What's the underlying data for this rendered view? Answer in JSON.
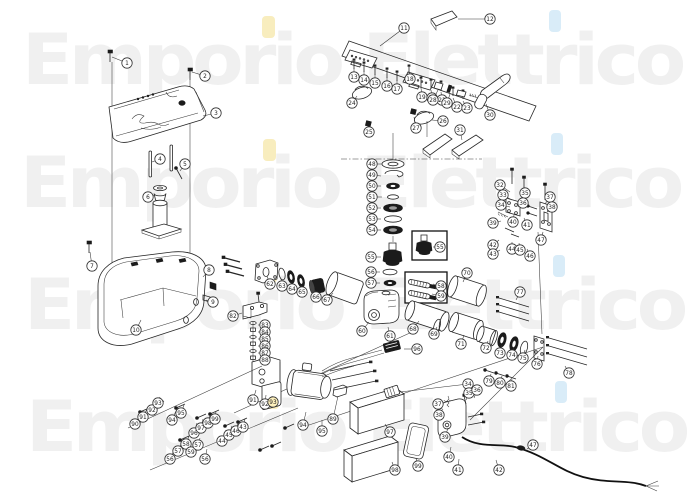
{
  "watermark": {
    "text": "Emporio Elettrico",
    "color": "#f0f0f0",
    "rows": [
      {
        "x": 22,
        "y": 84
      },
      {
        "x": 20,
        "y": 207
      },
      {
        "x": 24,
        "y": 329
      },
      {
        "x": 26,
        "y": 451
      }
    ],
    "accent_dots": [
      {
        "x": 262,
        "y": 16,
        "w": 13,
        "h": 22,
        "color": "#f6e9ae"
      },
      {
        "x": 263,
        "y": 139,
        "w": 13,
        "h": 22,
        "color": "#f6e9ae"
      },
      {
        "x": 264,
        "y": 261,
        "w": 13,
        "h": 22,
        "color": "#f6e9ae"
      },
      {
        "x": 266,
        "y": 387,
        "w": 13,
        "h": 22,
        "color": "#f6e9ae"
      },
      {
        "x": 549,
        "y": 10,
        "w": 12,
        "h": 22,
        "color": "#cfe7f6"
      },
      {
        "x": 551,
        "y": 133,
        "w": 12,
        "h": 22,
        "color": "#cfe7f6"
      },
      {
        "x": 553,
        "y": 255,
        "w": 12,
        "h": 22,
        "color": "#cfe7f6"
      },
      {
        "x": 555,
        "y": 381,
        "w": 12,
        "h": 22,
        "color": "#cfe7f6"
      }
    ]
  },
  "colors": {
    "background": "#ffffff",
    "line": "#262626",
    "dark_fill": "#1b1b1b",
    "balloon_stroke": "#333333",
    "balloon_text": "#222222",
    "highlight": "#fdf0bc"
  },
  "callouts": [
    {
      "n": 1,
      "x": 127,
      "y": 63,
      "lx": 112,
      "ly": 57
    },
    {
      "n": 2,
      "x": 205,
      "y": 76,
      "lx": 192,
      "ly": 72
    },
    {
      "n": 3,
      "x": 216,
      "y": 113,
      "lx": 203,
      "ly": 116
    },
    {
      "n": 4,
      "x": 160,
      "y": 159,
      "lx": 152,
      "ly": 162
    },
    {
      "n": 5,
      "x": 185,
      "y": 164,
      "lx": 180,
      "ly": 171
    },
    {
      "n": 6,
      "x": 148,
      "y": 197,
      "lx": 156,
      "ly": 195
    },
    {
      "n": 7,
      "x": 92,
      "y": 266,
      "lx": 90,
      "ly": 252
    },
    {
      "n": 8,
      "x": 209,
      "y": 270,
      "lx": 203,
      "ly": 277
    },
    {
      "n": 9,
      "x": 213,
      "y": 302,
      "lx": 206,
      "ly": 300
    },
    {
      "n": 10,
      "x": 136,
      "y": 330,
      "lx": 141,
      "ly": 320
    },
    {
      "n": 11,
      "x": 404,
      "y": 28,
      "lx": 380,
      "ly": 46
    },
    {
      "n": 12,
      "x": 490,
      "y": 19,
      "lx": 458,
      "ly": 19
    },
    {
      "n": 13,
      "x": 354,
      "y": 77,
      "lx": 354,
      "ly": 68
    },
    {
      "n": 14,
      "x": 364,
      "y": 80,
      "lx": 364,
      "ly": 71
    },
    {
      "n": 15,
      "x": 375,
      "y": 83,
      "lx": 375,
      "ly": 74
    },
    {
      "n": 16,
      "x": 387,
      "y": 86,
      "lx": 387,
      "ly": 77
    },
    {
      "n": 17,
      "x": 397,
      "y": 89,
      "lx": 397,
      "ly": 80
    },
    {
      "n": 18,
      "x": 410,
      "y": 79,
      "lx": 409,
      "ly": 71
    },
    {
      "n": 19,
      "x": 422,
      "y": 97,
      "lx": 421,
      "ly": 88
    },
    {
      "n": 20,
      "x": 432,
      "y": 98,
      "lx": 431,
      "ly": 90
    },
    {
      "n": 21,
      "x": 442,
      "y": 100,
      "lx": 441,
      "ly": 92
    },
    {
      "n": 22,
      "x": 457,
      "y": 107,
      "lx": 453,
      "ly": 98
    },
    {
      "n": 23,
      "x": 467,
      "y": 108,
      "lx": 463,
      "ly": 101
    },
    {
      "n": 24,
      "x": 352,
      "y": 103,
      "lx": 357,
      "ly": 96
    },
    {
      "n": 25,
      "x": 369,
      "y": 132,
      "lx": 368,
      "ly": 127
    },
    {
      "n": 26,
      "x": 443,
      "y": 121,
      "lx": 432,
      "ly": 120
    },
    {
      "n": 27,
      "x": 416,
      "y": 128,
      "lx": 414,
      "ly": 117
    },
    {
      "n": 28,
      "x": 433,
      "y": 100,
      "lx": 438,
      "ly": 90
    },
    {
      "n": 29,
      "x": 447,
      "y": 103,
      "lx": 450,
      "ly": 94
    },
    {
      "n": 30,
      "x": 490,
      "y": 115,
      "lx": 486,
      "ly": 104
    },
    {
      "n": 31,
      "x": 460,
      "y": 130,
      "lx": 462,
      "ly": 140
    },
    {
      "n": 32,
      "x": 500,
      "y": 185,
      "lx": 510,
      "ly": 192
    },
    {
      "n": 33,
      "x": 503,
      "y": 195,
      "lx": 512,
      "ly": 200
    },
    {
      "n": 34,
      "x": 501,
      "y": 205,
      "lx": 510,
      "ly": 207
    },
    {
      "n": 35,
      "x": 525,
      "y": 193,
      "lx": 520,
      "ly": 200
    },
    {
      "n": 36,
      "x": 523,
      "y": 203,
      "lx": 518,
      "ly": 207
    },
    {
      "n": 37,
      "x": 550,
      "y": 197,
      "lx": 545,
      "ly": 204
    },
    {
      "n": 38,
      "x": 552,
      "y": 207,
      "lx": 547,
      "ly": 212
    },
    {
      "n": 39,
      "x": 493,
      "y": 223,
      "lx": 501,
      "ly": 221
    },
    {
      "n": 40,
      "x": 513,
      "y": 222,
      "lx": 514,
      "ly": 215
    },
    {
      "n": 41,
      "x": 527,
      "y": 225,
      "lx": 524,
      "ly": 218
    },
    {
      "n": 42,
      "x": 493,
      "y": 245,
      "lx": 499,
      "ly": 240
    },
    {
      "n": 43,
      "x": 493,
      "y": 254,
      "lx": 500,
      "ly": 250
    },
    {
      "n": 44,
      "x": 512,
      "y": 249,
      "lx": 512,
      "ly": 242
    },
    {
      "n": 45,
      "x": 520,
      "y": 250,
      "lx": 519,
      "ly": 243
    },
    {
      "n": 46,
      "x": 530,
      "y": 256,
      "lx": 527,
      "ly": 249
    },
    {
      "n": 47,
      "x": 541,
      "y": 240,
      "lx": 543,
      "ly": 232
    },
    {
      "n": 48,
      "x": 372,
      "y": 164,
      "lx": 382,
      "ly": 164
    },
    {
      "n": 49,
      "x": 372,
      "y": 175,
      "lx": 381,
      "ly": 176
    },
    {
      "n": 50,
      "x": 372,
      "y": 186,
      "lx": 381,
      "ly": 186
    },
    {
      "n": 51,
      "x": 372,
      "y": 197,
      "lx": 382,
      "ly": 197
    },
    {
      "n": 52,
      "x": 372,
      "y": 208,
      "lx": 381,
      "ly": 208
    },
    {
      "n": 53,
      "x": 372,
      "y": 219,
      "lx": 381,
      "ly": 219
    },
    {
      "n": 54,
      "x": 372,
      "y": 230,
      "lx": 381,
      "ly": 230
    },
    {
      "n": 55,
      "x": 371,
      "y": 257,
      "lx": 381,
      "ly": 257
    },
    {
      "n": 55,
      "x": 440,
      "y": 247,
      "lx": 433,
      "ly": 247
    },
    {
      "n": 56,
      "x": 371,
      "y": 272,
      "lx": 380,
      "ly": 272
    },
    {
      "n": 57,
      "x": 371,
      "y": 283,
      "lx": 380,
      "ly": 283
    },
    {
      "n": 58,
      "x": 441,
      "y": 286,
      "lx": 433,
      "ly": 284
    },
    {
      "n": 59,
      "x": 441,
      "y": 296,
      "lx": 432,
      "ly": 294
    },
    {
      "n": 60,
      "x": 362,
      "y": 331,
      "lx": 369,
      "ly": 322
    },
    {
      "n": 61,
      "x": 390,
      "y": 336,
      "lx": 388,
      "ly": 327
    },
    {
      "n": 62,
      "x": 270,
      "y": 284,
      "lx": 267,
      "ly": 276
    },
    {
      "n": 63,
      "x": 282,
      "y": 286,
      "lx": 281,
      "ly": 279
    },
    {
      "n": 64,
      "x": 292,
      "y": 289,
      "lx": 291,
      "ly": 282
    },
    {
      "n": 65,
      "x": 302,
      "y": 292,
      "lx": 301,
      "ly": 285
    },
    {
      "n": 66,
      "x": 316,
      "y": 297,
      "lx": 315,
      "ly": 290
    },
    {
      "n": 67,
      "x": 327,
      "y": 300,
      "lx": 333,
      "ly": 293
    },
    {
      "n": 68,
      "x": 413,
      "y": 329,
      "lx": 419,
      "ly": 321
    },
    {
      "n": 69,
      "x": 434,
      "y": 334,
      "lx": 437,
      "ly": 327
    },
    {
      "n": 70,
      "x": 467,
      "y": 273,
      "lx": 463,
      "ly": 282
    },
    {
      "n": 71,
      "x": 461,
      "y": 344,
      "lx": 464,
      "ly": 335
    },
    {
      "n": 72,
      "x": 486,
      "y": 348,
      "lx": 488,
      "ly": 341
    },
    {
      "n": 73,
      "x": 500,
      "y": 353,
      "lx": 502,
      "ly": 345
    },
    {
      "n": 74,
      "x": 512,
      "y": 355,
      "lx": 514,
      "ly": 347
    },
    {
      "n": 75,
      "x": 523,
      "y": 358,
      "lx": 525,
      "ly": 350
    },
    {
      "n": 76,
      "x": 537,
      "y": 364,
      "lx": 538,
      "ly": 356
    },
    {
      "n": 77,
      "x": 520,
      "y": 292,
      "lx": 516,
      "ly": 300
    },
    {
      "n": 78,
      "x": 569,
      "y": 373,
      "lx": 565,
      "ly": 366
    },
    {
      "n": 79,
      "x": 489,
      "y": 381,
      "lx": 491,
      "ly": 374
    },
    {
      "n": 80,
      "x": 500,
      "y": 383,
      "lx": 502,
      "ly": 376
    },
    {
      "n": 81,
      "x": 511,
      "y": 386,
      "lx": 512,
      "ly": 379
    },
    {
      "n": 82,
      "x": 233,
      "y": 316,
      "lx": 242,
      "ly": 313
    },
    {
      "n": 83,
      "x": 265,
      "y": 325,
      "lx": 258,
      "ly": 325
    },
    {
      "n": 84,
      "x": 265,
      "y": 332,
      "lx": 258,
      "ly": 332
    },
    {
      "n": 85,
      "x": 265,
      "y": 339,
      "lx": 258,
      "ly": 339
    },
    {
      "n": 86,
      "x": 265,
      "y": 346,
      "lx": 258,
      "ly": 346
    },
    {
      "n": 87,
      "x": 265,
      "y": 353,
      "lx": 258,
      "ly": 353
    },
    {
      "n": 88,
      "x": 265,
      "y": 360,
      "lx": 258,
      "ly": 360
    },
    {
      "n": 89,
      "x": 333,
      "y": 419,
      "lx": 338,
      "ly": 396
    },
    {
      "n": 90,
      "x": 135,
      "y": 424,
      "lx": 141,
      "ly": 414
    },
    {
      "n": 91,
      "x": 143,
      "y": 417,
      "lx": 147,
      "ly": 409
    },
    {
      "n": 92,
      "x": 152,
      "y": 410,
      "lx": 155,
      "ly": 403
    },
    {
      "n": 93,
      "x": 158,
      "y": 403,
      "lx": 160,
      "ly": 397
    },
    {
      "n": 94,
      "x": 172,
      "y": 420,
      "lx": 176,
      "ly": 411
    },
    {
      "n": 95,
      "x": 181,
      "y": 413,
      "lx": 184,
      "ly": 405
    },
    {
      "n": 96,
      "x": 194,
      "y": 433,
      "lx": 197,
      "ly": 423
    },
    {
      "n": 97,
      "x": 201,
      "y": 428,
      "lx": 203,
      "ly": 419
    },
    {
      "n": 98,
      "x": 208,
      "y": 423,
      "lx": 210,
      "ly": 415
    },
    {
      "n": 99,
      "x": 215,
      "y": 419,
      "lx": 216,
      "ly": 411
    },
    {
      "n": 44,
      "x": 222,
      "y": 441,
      "lx": 226,
      "ly": 430
    },
    {
      "n": 45,
      "x": 229,
      "y": 435,
      "lx": 232,
      "ly": 426
    },
    {
      "n": 46,
      "x": 236,
      "y": 431,
      "lx": 238,
      "ly": 423
    },
    {
      "n": 43,
      "x": 243,
      "y": 427,
      "lx": 245,
      "ly": 419
    },
    {
      "n": 56,
      "x": 170,
      "y": 459,
      "lx": 175,
      "ly": 448
    },
    {
      "n": 57,
      "x": 178,
      "y": 451,
      "lx": 182,
      "ly": 442
    },
    {
      "n": 58,
      "x": 186,
      "y": 444,
      "lx": 189,
      "ly": 436
    },
    {
      "n": 59,
      "x": 191,
      "y": 452,
      "lx": 194,
      "ly": 443
    },
    {
      "n": 57,
      "x": 198,
      "y": 445,
      "lx": 200,
      "ly": 438
    },
    {
      "n": 56,
      "x": 205,
      "y": 459,
      "lx": 207,
      "ly": 449
    },
    {
      "n": 91,
      "x": 253,
      "y": 400,
      "lx": 256,
      "ly": 390
    },
    {
      "n": 92,
      "x": 265,
      "y": 404,
      "lx": 266,
      "ly": 395
    },
    {
      "n": 93,
      "x": 273,
      "y": 402,
      "lx": 272,
      "ly": 396,
      "h": true
    },
    {
      "n": 94,
      "x": 303,
      "y": 425,
      "lx": 306,
      "ly": 412
    },
    {
      "n": 95,
      "x": 322,
      "y": 431,
      "lx": 322,
      "ly": 420
    },
    {
      "n": 96,
      "x": 417,
      "y": 349,
      "lx": 404,
      "ly": 349
    },
    {
      "n": 97,
      "x": 390,
      "y": 432,
      "lx": 385,
      "ly": 424
    },
    {
      "n": 98,
      "x": 395,
      "y": 470,
      "lx": 392,
      "ly": 462
    },
    {
      "n": 99,
      "x": 418,
      "y": 466,
      "lx": 416,
      "ly": 458
    },
    {
      "n": 34,
      "x": 468,
      "y": 384,
      "lx": 400,
      "ly": 392
    },
    {
      "n": 35,
      "x": 469,
      "y": 393,
      "lx": 466,
      "ly": 400
    },
    {
      "n": 36,
      "x": 477,
      "y": 390,
      "lx": 474,
      "ly": 398
    },
    {
      "n": 37,
      "x": 438,
      "y": 404,
      "lx": 443,
      "ly": 410
    },
    {
      "n": 38,
      "x": 439,
      "y": 415,
      "lx": 444,
      "ly": 418
    },
    {
      "n": 39,
      "x": 445,
      "y": 437,
      "lx": 448,
      "ly": 428
    },
    {
      "n": 40,
      "x": 449,
      "y": 457,
      "lx": 451,
      "ly": 447
    },
    {
      "n": 41,
      "x": 458,
      "y": 470,
      "lx": 459,
      "ly": 459
    },
    {
      "n": 42,
      "x": 499,
      "y": 470,
      "lx": 496,
      "ly": 460
    },
    {
      "n": 47,
      "x": 533,
      "y": 445,
      "lx": 527,
      "ly": 449
    }
  ]
}
